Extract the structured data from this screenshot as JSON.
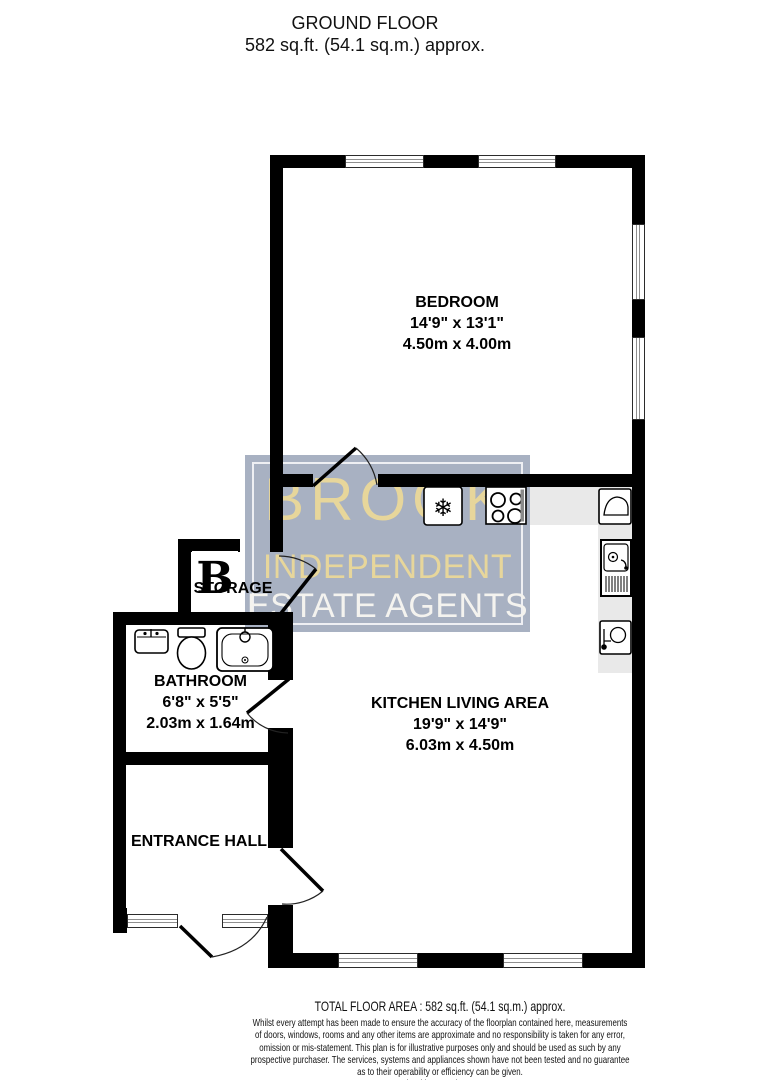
{
  "header": {
    "title": "GROUND FLOOR",
    "subtitle": "582 sq.ft. (54.1 sq.m.) approx."
  },
  "watermark": {
    "brand_line1": "BROOK",
    "brand_line2": "INDEPENDENT",
    "brand_line3": "ESTATE AGENTS",
    "logo_letter": "B",
    "bg_color": "#a8b1c2",
    "gold_color": "#e7d69b",
    "white_color": "#f4f3ef"
  },
  "rooms": {
    "bedroom": {
      "name": "BEDROOM",
      "imperial": "14'9\" x 13'1\"",
      "metric": "4.50m x 4.00m"
    },
    "kitchen_living": {
      "name": "KITCHEN LIVING AREA",
      "imperial": "19'9\" x 14'9\"",
      "metric": "6.03m x 4.50m"
    },
    "bathroom": {
      "name": "BATHROOM",
      "imperial": "6'8\" x 5'5\"",
      "metric": "2.03m x 1.64m"
    },
    "storage": {
      "name": "STORAGE"
    },
    "entrance_hall": {
      "name": "ENTRANCE HALL"
    }
  },
  "icons": {
    "fridge_snowflake": "❄"
  },
  "colors": {
    "wall": "#000000",
    "counter": "#e9e9e9"
  },
  "footer": {
    "total": "TOTAL FLOOR AREA : 582 sq.ft. (54.1 sq.m.) approx.",
    "disclaimer": "Whilst every attempt has been made to ensure the accuracy of the floorplan contained here, measurements\nof doors, windows, rooms and any other items are approximate and no responsibility is taken for any error,\nomission or mis-statement. This plan is for illustrative purposes only and should be used as such by any\nprospective purchaser. The services, systems and appliances shown have not been tested and no guarantee\nas to their operability or efficiency can be given.",
    "credit": "Made with Metropix ©2023"
  }
}
